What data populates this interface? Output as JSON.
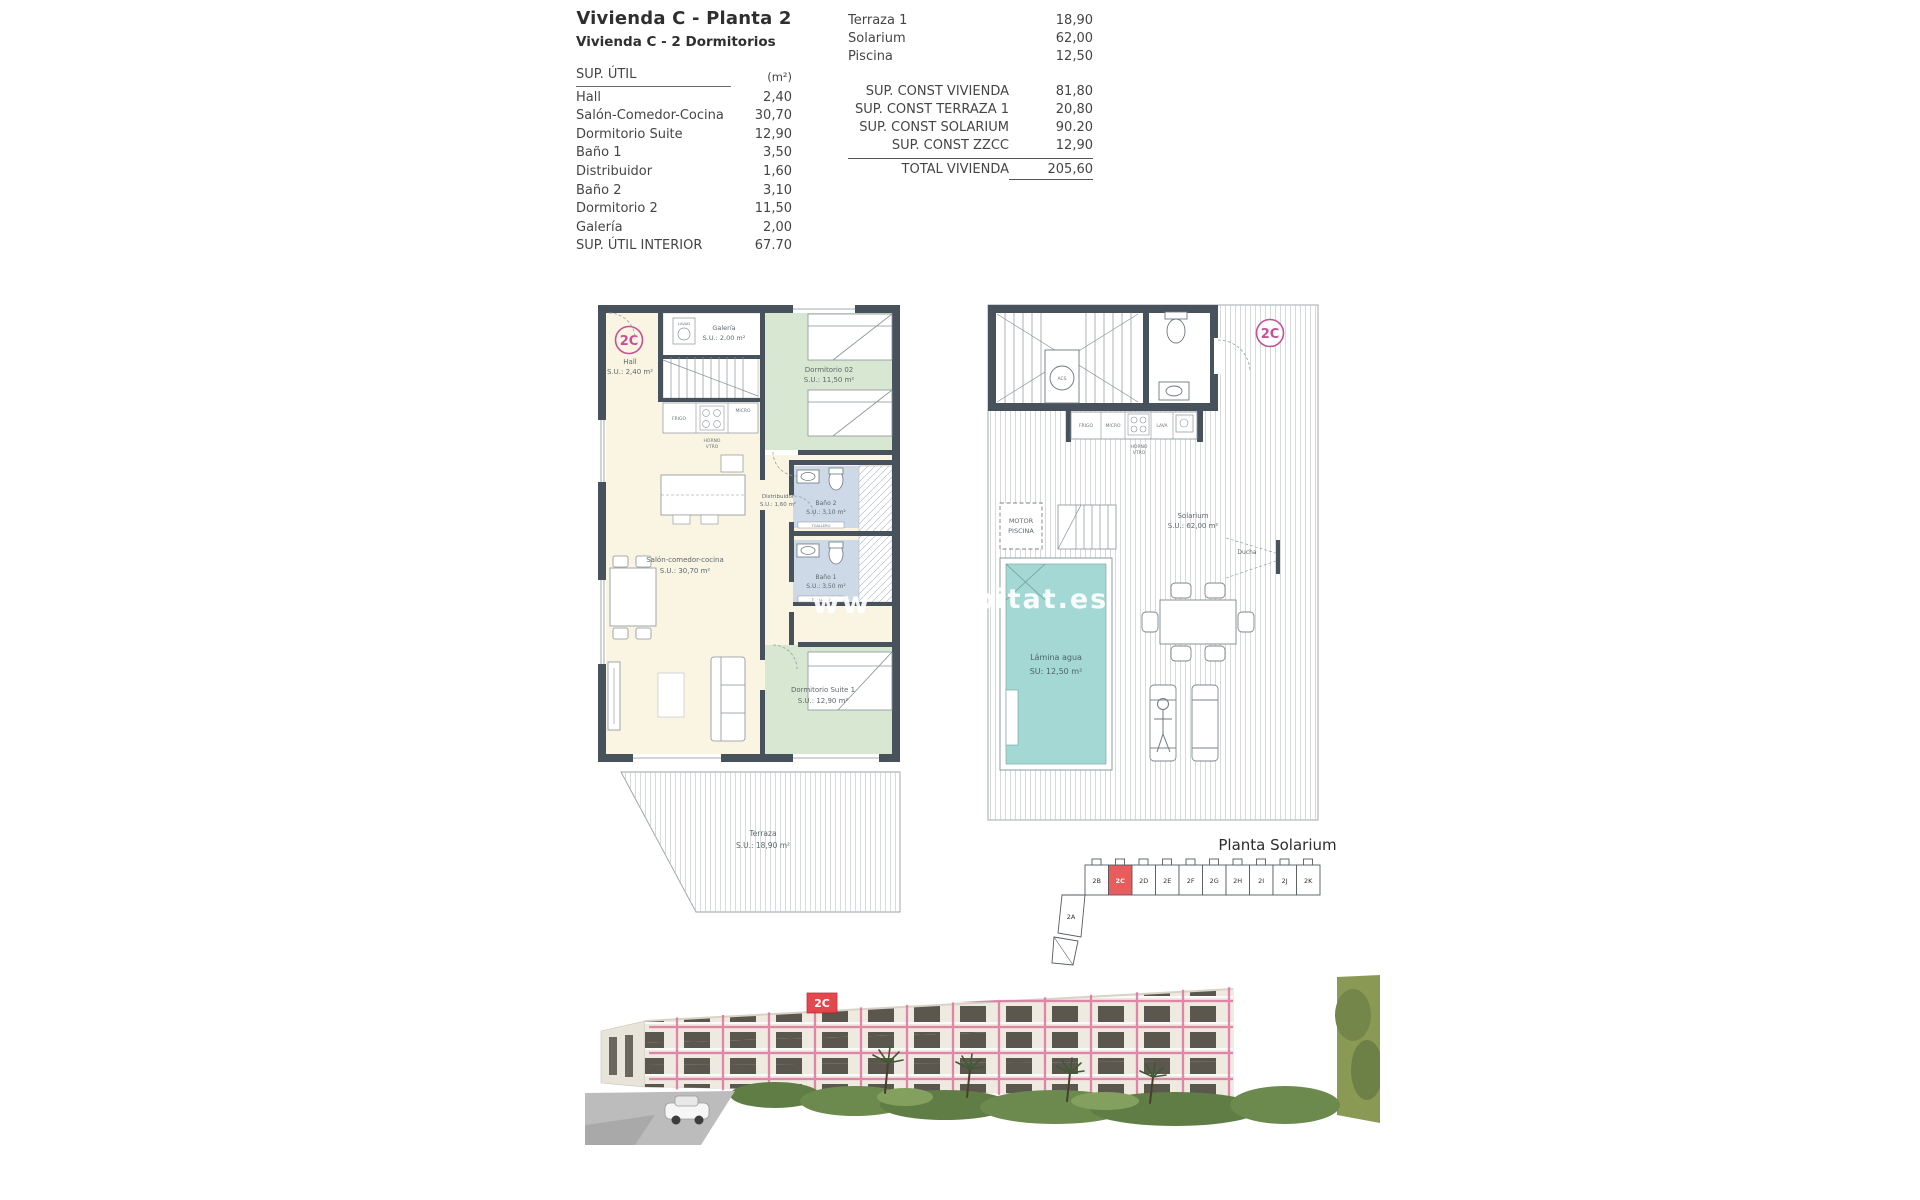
{
  "header": {
    "title": "Vivienda C - Planta 2",
    "subtitle": "Vivienda C - 2 Dormitorios"
  },
  "sup_util_table": {
    "header_label": "SUP. ÚTIL",
    "header_unit": "(m²)",
    "rows": [
      {
        "label": "Hall",
        "value": "2,40"
      },
      {
        "label": "Salón-Comedor-Cocina",
        "value": "30,70"
      },
      {
        "label": "Dormitorio Suite",
        "value": "12,90"
      },
      {
        "label": "Baño 1",
        "value": "3,50"
      },
      {
        "label": "Distribuidor",
        "value": "1,60"
      },
      {
        "label": "Baño 2",
        "value": "3,10"
      },
      {
        "label": "Dormitorio 2",
        "value": "11,50"
      },
      {
        "label": "Galería",
        "value": "2,00"
      }
    ],
    "total": {
      "label": "SUP. ÚTIL INTERIOR",
      "value": "67.70"
    }
  },
  "summary_table": {
    "exterior_rows": [
      {
        "label": "Terraza 1",
        "value": "18,90"
      },
      {
        "label": "Solarium",
        "value": "62,00"
      },
      {
        "label": "Piscina",
        "value": "12,50"
      }
    ],
    "const_rows": [
      {
        "label": "SUP. CONST VIVIENDA",
        "value": "81,80"
      },
      {
        "label": "SUP. CONST TERRAZA 1",
        "value": "20,80"
      },
      {
        "label": "SUP. CONST SOLARIUM",
        "value": "90.20"
      },
      {
        "label": "SUP. CONST ZZCC",
        "value": "12,90"
      }
    ],
    "total": {
      "label": "TOTAL VIVIENDA",
      "value": "205,60"
    }
  },
  "floor_plan": {
    "unit_badge": "2C",
    "rooms": {
      "hall": {
        "name": "Hall",
        "area": "S.U.: 2,40 m²"
      },
      "galeria": {
        "name": "Galería",
        "area": "S.U.: 2,00 m²"
      },
      "dormitorio2": {
        "name": "Dormitorio 02",
        "area": "S.U.: 11,50 m²"
      },
      "salon": {
        "name": "Salón-comedor-cocina",
        "area": "S.U.: 30,70 m²"
      },
      "distribuidor": {
        "name": "Distribuidor",
        "area": "S.U.: 1,60 m²"
      },
      "bano2": {
        "name": "Baño 2",
        "area": "S.U.: 3,10 m²"
      },
      "bano1": {
        "name": "Baño 1",
        "area": "S.U.: 3,50 m²"
      },
      "suite": {
        "name": "Dormitorio Suite 1",
        "area": "S.U.: 12,90 m²"
      },
      "terraza": {
        "name": "Terraza",
        "area": "S.U.: 18,90 m²"
      }
    },
    "fixtures": {
      "frigo": "FRIGO",
      "micro": "MICRO",
      "horno1": "HORNO",
      "horno2": "VTRO",
      "lava": "LAVA",
      "lavad": "LAVAD",
      "toallero": "TOALLERO"
    }
  },
  "solarium_plan": {
    "unit_badge": "2C",
    "motor_line1": "MOTOR",
    "motor_line2": "PISCINA",
    "solarium": {
      "name": "Solarium",
      "area": "S.U.: 62,00 m²"
    },
    "pool": {
      "line1": "Lámina agua",
      "line2": "SU:  12,50 m²"
    },
    "ducha": "Ducha",
    "acs": "ACS",
    "fixtures": {
      "frigo": "FRIGO",
      "micro": "MICRO",
      "horno1": "HORNO",
      "horno2": "VTRO",
      "lava": "LAVA"
    }
  },
  "key_plan": {
    "title": "Planta Solarium",
    "units": [
      "2B",
      "2C",
      "2D",
      "2E",
      "2F",
      "2G",
      "2H",
      "2I",
      "2J",
      "2K"
    ],
    "highlighted_unit": "2C",
    "lower_unit": "2A"
  },
  "render": {
    "unit_badge": "2C"
  },
  "watermark": {
    "fragment_left": "ww",
    "fragment_right": "bitat.es"
  },
  "colors": {
    "wall": "#47525c",
    "bedroom": "#d7e7d2",
    "living": "#faf4e3",
    "bath": "#cdd9e7",
    "pool": "#a3d8d4",
    "badge_pink": "#c84f96",
    "key_highlight": "#e95c5c",
    "render_outline": "#dd6d9e"
  }
}
